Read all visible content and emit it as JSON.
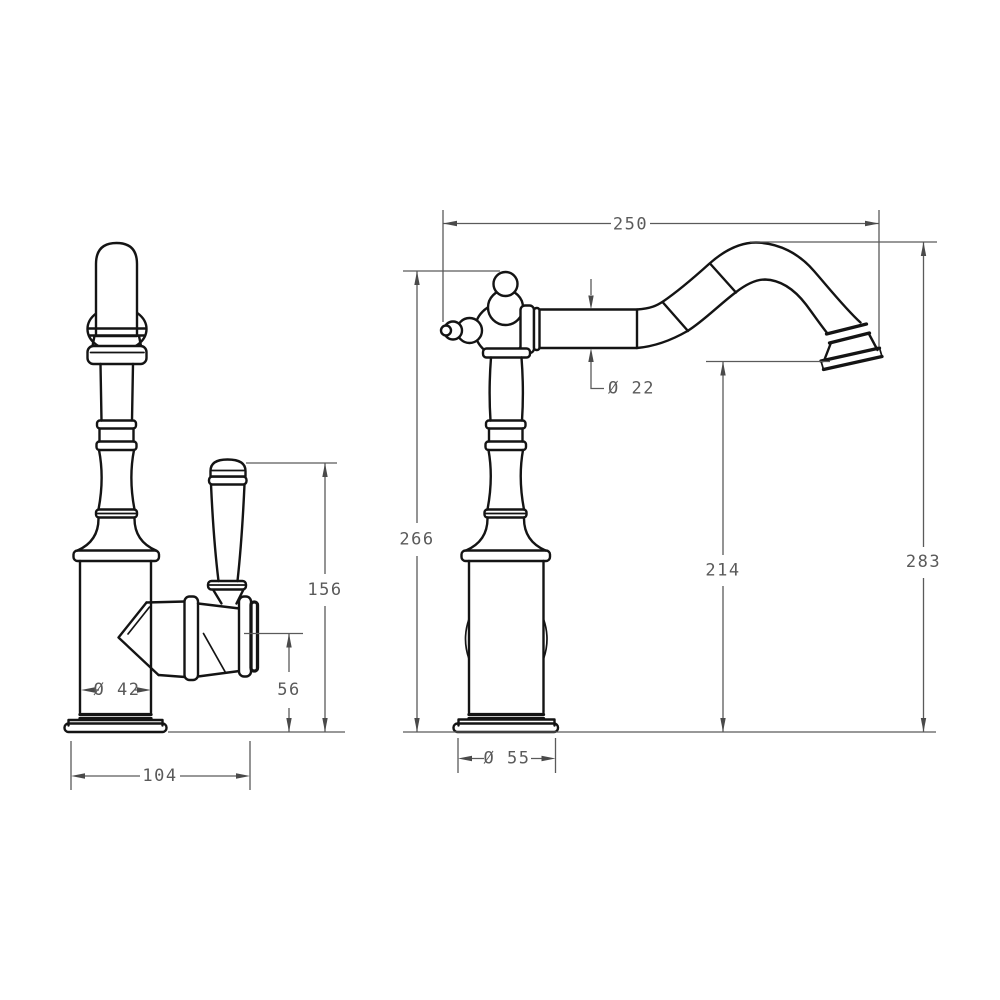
{
  "drawing": {
    "type": "technical-dimension-drawing",
    "subject": "traditional-kitchen-faucet",
    "colors": {
      "background": "#ffffff",
      "object_line": "#141414",
      "dimension_line": "#5a5a5a"
    },
    "dimensions": {
      "spout_reach": {
        "label": "250"
      },
      "height_to_handle_ball": {
        "label": "266"
      },
      "height_to_spout_top": {
        "label": "283"
      },
      "spout_outlet_height": {
        "label": "214"
      },
      "spout_tube_diameter": {
        "label": "Ø 22"
      },
      "body_diameter": {
        "label": "Ø 42"
      },
      "base_diameter": {
        "label": "Ø 55"
      },
      "side_view_depth": {
        "label": "104"
      },
      "handle_top_height": {
        "label": "156"
      },
      "valve_center_height": {
        "label": "56"
      }
    }
  }
}
